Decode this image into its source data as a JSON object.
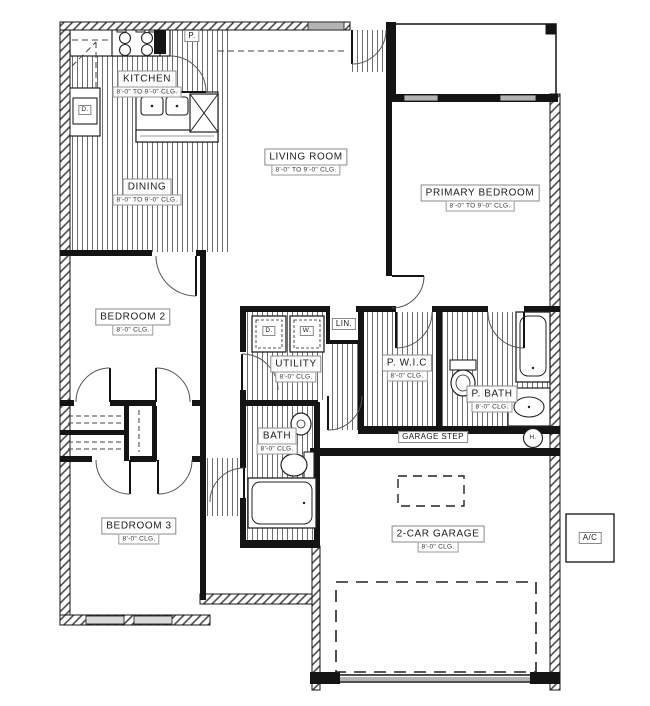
{
  "plan": {
    "rooms": {
      "kitchen": {
        "name": "KITCHEN",
        "ceiling": "8'-0\" TO 9'-0\" CLG."
      },
      "dining": {
        "name": "DINING",
        "ceiling": "8'-0\" TO 9'-0\" CLG."
      },
      "living_room": {
        "name": "LIVING ROOM",
        "ceiling": "8'-0\" TO 9'-0\" CLG."
      },
      "primary_bedroom": {
        "name": "PRIMARY BEDROOM",
        "ceiling": "8'-0\" TO 9'-0\" CLG."
      },
      "bedroom_2": {
        "name": "BEDROOM 2",
        "ceiling": "8'-0\" CLG."
      },
      "bedroom_3": {
        "name": "BEDROOM 3",
        "ceiling": "8'-0\" CLG."
      },
      "utility": {
        "name": "UTILITY",
        "ceiling": "8'-0\" CLG."
      },
      "pwic": {
        "name": "P. W.I.C",
        "ceiling": "8'-0\" CLG."
      },
      "p_bath": {
        "name": "P. BATH",
        "ceiling": "8'-0\" CLG."
      },
      "bath": {
        "name": "BATH",
        "ceiling": "8'-0\" CLG."
      },
      "garage": {
        "name": "2-CAR GARAGE",
        "ceiling": "8'-0\" CLG."
      }
    },
    "small_labels": {
      "pantry": "P.",
      "linen": "LIN.",
      "dryer": "D.",
      "washer": "W.",
      "kitchen_appliance": "D.",
      "water_heater": "H.",
      "ac_unit": "A/C",
      "garage_step": "GARAGE STEP"
    },
    "colors": {
      "wall": "#141414",
      "window": "#b3b3b3",
      "stripe": "#4a4a4a",
      "label_border": "#8a8a8a"
    }
  }
}
